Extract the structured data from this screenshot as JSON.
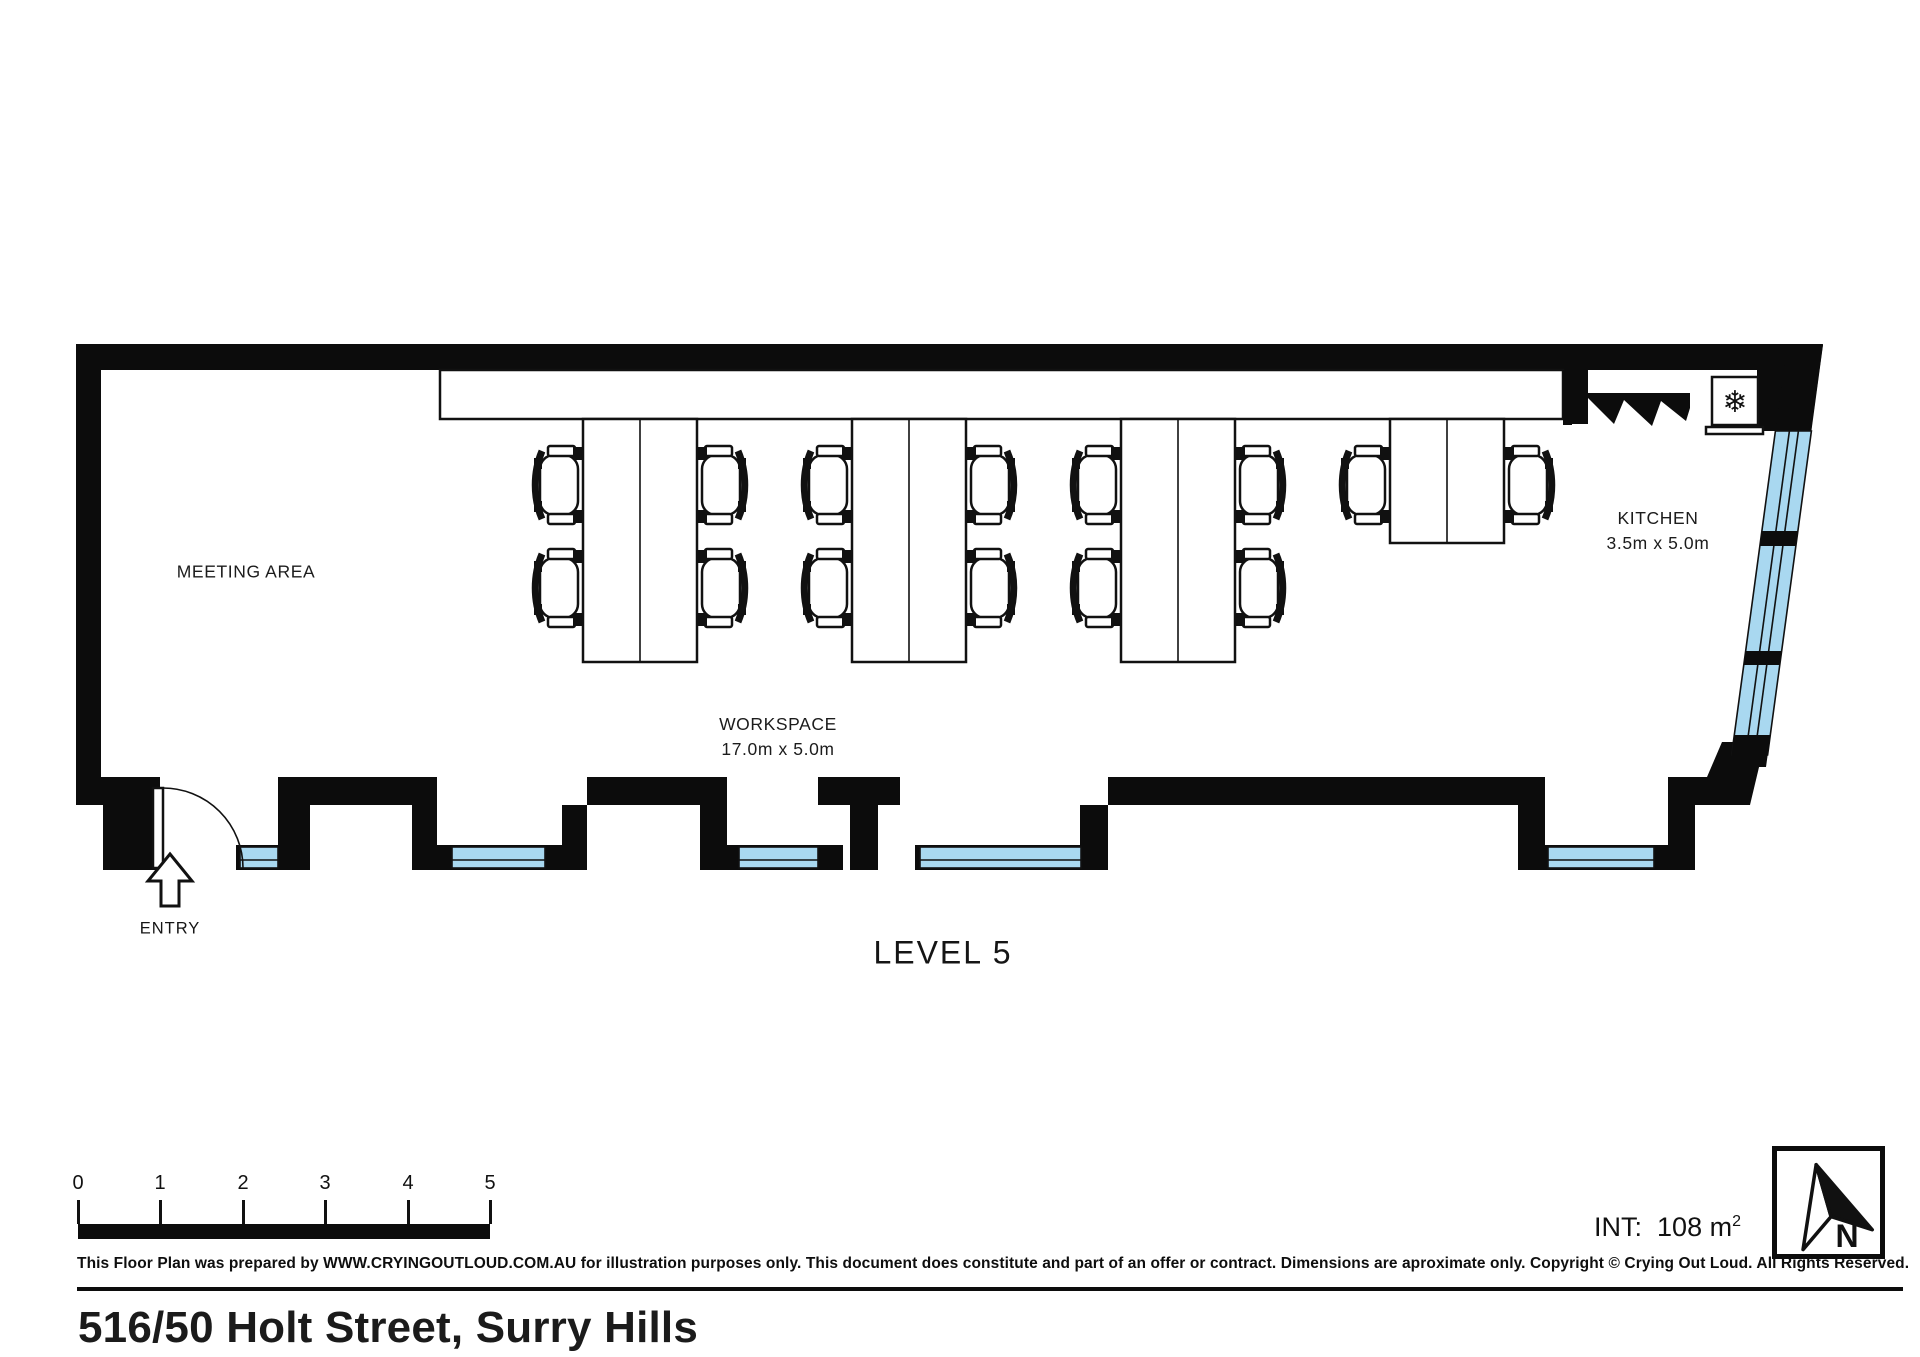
{
  "plan": {
    "level_label": "LEVEL 5",
    "rooms": {
      "meeting_area": {
        "label": "MEETING AREA"
      },
      "workspace": {
        "label": "WORKSPACE",
        "dimensions": "17.0m x 5.0m",
        "desk_groups": [
          {
            "chairs": 4
          },
          {
            "chairs": 4
          },
          {
            "chairs": 4
          },
          {
            "chairs": 2
          }
        ]
      },
      "kitchen": {
        "label": "KITCHEN",
        "dimensions": "3.5m x 5.0m"
      }
    },
    "entry": {
      "label": "ENTRY"
    },
    "icons": {
      "fridge_snowflake": "❄"
    }
  },
  "footer": {
    "scale_bar": {
      "labels": [
        "0",
        "1",
        "2",
        "3",
        "4",
        "5"
      ]
    },
    "area_label": "INT:",
    "area_value": "108 m",
    "area_superscript": "2",
    "north_label": "N",
    "disclaimer": "This Floor Plan was prepared by WWW.CRYINGOUTLOUD.COM.AU for illustration purposes only. This document does constitute and part of an offer or contract. Dimensions are aproximate only. Copyright © Crying Out Loud. All Rights Reserved.",
    "address": "516/50 Holt Street, Surry Hills"
  },
  "colors": {
    "wall": "#0c0c0c",
    "window_glass": "#A9D8F0",
    "line": "#111111"
  }
}
